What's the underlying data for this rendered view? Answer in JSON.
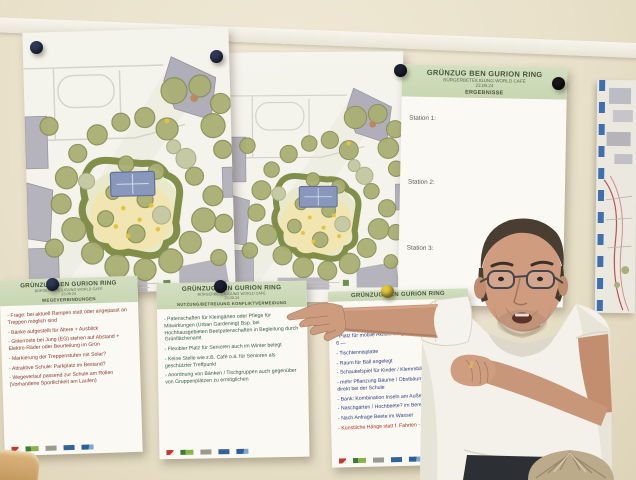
{
  "results_poster": {
    "title": "GRÜNZUG BEN GURION RING",
    "subtitle": "BÜRGERBETEILIGUNG WORLD CAFÉ",
    "date": "23.09.24",
    "section": "ERGEBNISSE",
    "stations": [
      "Station 1:",
      "Station 2:",
      "Station 3:"
    ]
  },
  "poster_wege": {
    "title": "GRÜNZUG BEN GURION RING",
    "subtitle": "BÜRGERBETEILIGUNG WORLD CAFÉ",
    "date": "23.09.24",
    "section": "WEGEVERBINDUNGEN",
    "items": [
      "- Frage: bei aktuell Rampen statt oder angepasst an Treppen möglich sind",
      "- Bänke aufgestellt für Ältere + Ausblick",
      "- Gitterroste bei Jung (EG) stehen auf Abstand + Elektro-Räder oder Beurteilung im Grün",
      "- Markierung der Treppenstufen mit Solar?",
      "- Attraktive Schule: Parkplatz im Bestand?",
      "- Wegeverlauf passend zur Schule am Rollen (Vorhandene Sportlichkeit am Laufen)"
    ]
  },
  "poster_nutzung": {
    "title": "GRÜNZUG BEN GURION RING",
    "subtitle": "BÜRGERBETEILIGUNG WORLD CAFÉ",
    "date": "23.09.24",
    "section": "NUTZUNG/BETREUUNG KONFLIKTVERMEIDUNG",
    "items": [
      "- Patenschaften für Kleingärten oder Pflege für Mitwirkungen (Urban Gardening) Bsp. bei Hochhausgebieten Beetpatenschaften in Begleitung durch Grünflächenamt",
      "- Flexibler Platz für Senioren auch im Winter belegt",
      "- Keine Stelle wie z.B. Café o.ä. für Senioren als geschützter Treffpunkt",
      "- Anordnung von Bänken / Tischgruppen auch gegenüber von Gruppenplätzen zu ermöglichen"
    ]
  },
  "poster_spiel": {
    "title": "GRÜNZUG BEN GURION RING",
    "items": [
      "- Spiel",
      "- Sitzplatz gestaltet (Wartespiel?) + Bank - Tisch - Schach",
      "- Platz für mobile Aktion! wiegend 4 Tischtennis ca 4 x 6 —",
      "- Tischtennisplatte",
      "- Raum für Ball angelegt",
      "- Schaukelspiel für Kinder / Klemmbänke - Ausrüstung",
      "- mehr Pflanzung Bäume / Obstbäume zu 4 x 6 m direkt bei der Schule",
      "- Bank: Kombination Inseln am Außenbereich",
      "- Naschgärten / Hochbeete? im Bereich zum Nutzen",
      "- Nach Anfrage Beete im Wasser"
    ],
    "item_red": "- Künstliche Hänge statt f. Fahrten - Nähe"
  },
  "colors": {
    "header_band": "#cdd9b7",
    "ink_left": "#8a3b2c",
    "ink_middle": "#3a5e49",
    "ink_right": "#2e3f7e",
    "ink_red": "#b03427",
    "pin_navy": "#2e3a58",
    "pin_black": "#17171a",
    "pin_yellow": "#e2c83e",
    "wall": "#e9e1ca"
  }
}
